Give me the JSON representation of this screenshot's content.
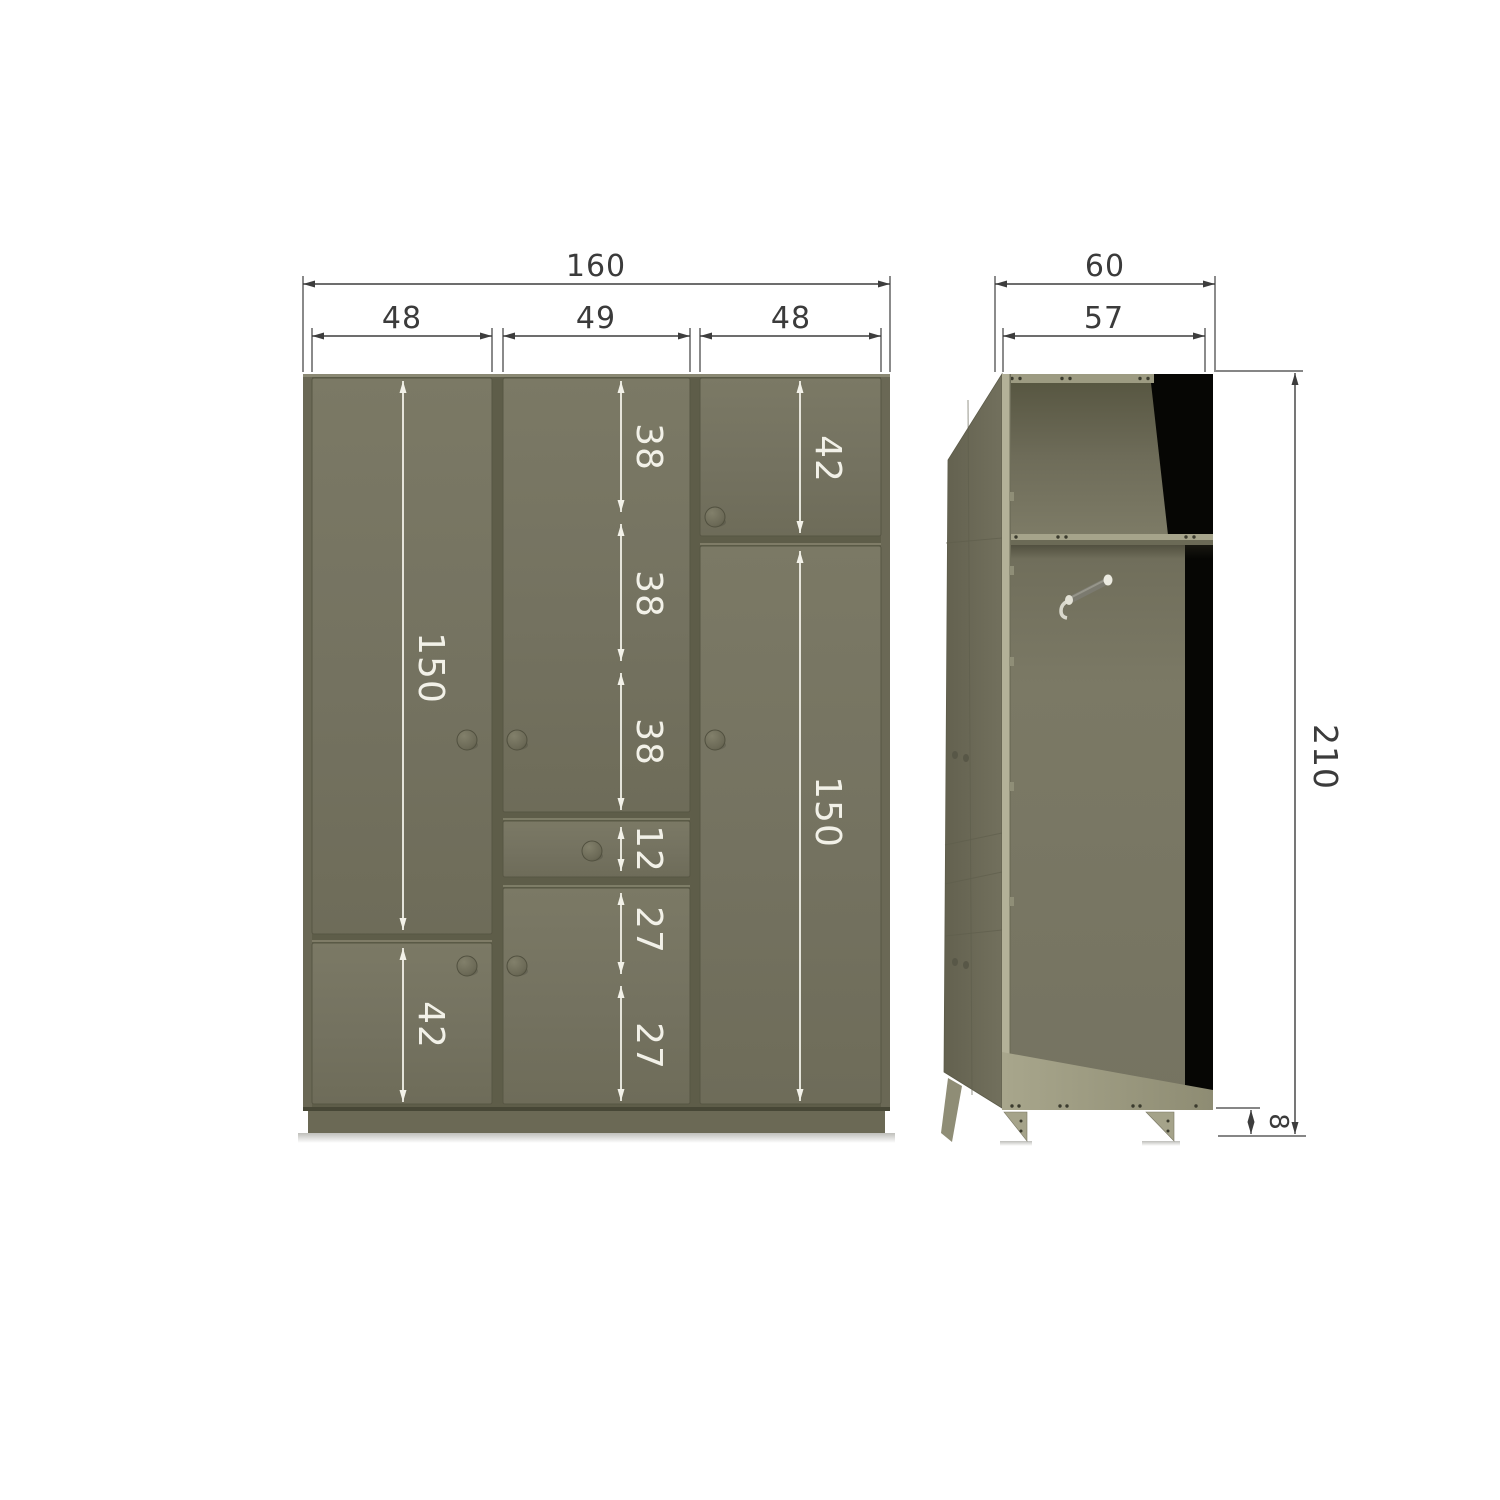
{
  "diagram": {
    "subject": "wardrobe-dimension-drawing",
    "views": {
      "front": "front-view",
      "side": "side-view-open"
    }
  },
  "dims": {
    "front": {
      "total_width": "160",
      "col1_width": "48",
      "col2_width": "49",
      "col3_width": "48",
      "left_door_height": "150",
      "left_lower_door_height": "42",
      "mid_seg1": "38",
      "mid_seg2": "38",
      "mid_seg3": "38",
      "drawer_height": "12",
      "mid_seg5": "27",
      "mid_seg6": "27",
      "right_top_door_height": "42",
      "right_door_height": "150"
    },
    "side": {
      "depth_total": "60",
      "depth_inner": "57",
      "height_total": "210",
      "foot_height": "8"
    }
  },
  "colors": {
    "body_olive": "#757360",
    "gap_dark": "#5e5d49",
    "plinth": "#6b6955",
    "interior_back_upper": "#6f6d5a",
    "interior_back_lower": "#787663",
    "interior_side_black": "#060604",
    "edge_light": "#b3b198",
    "dim_black": "#3d3d3d",
    "dim_white": "#f2f1e8",
    "background": "#ffffff"
  }
}
